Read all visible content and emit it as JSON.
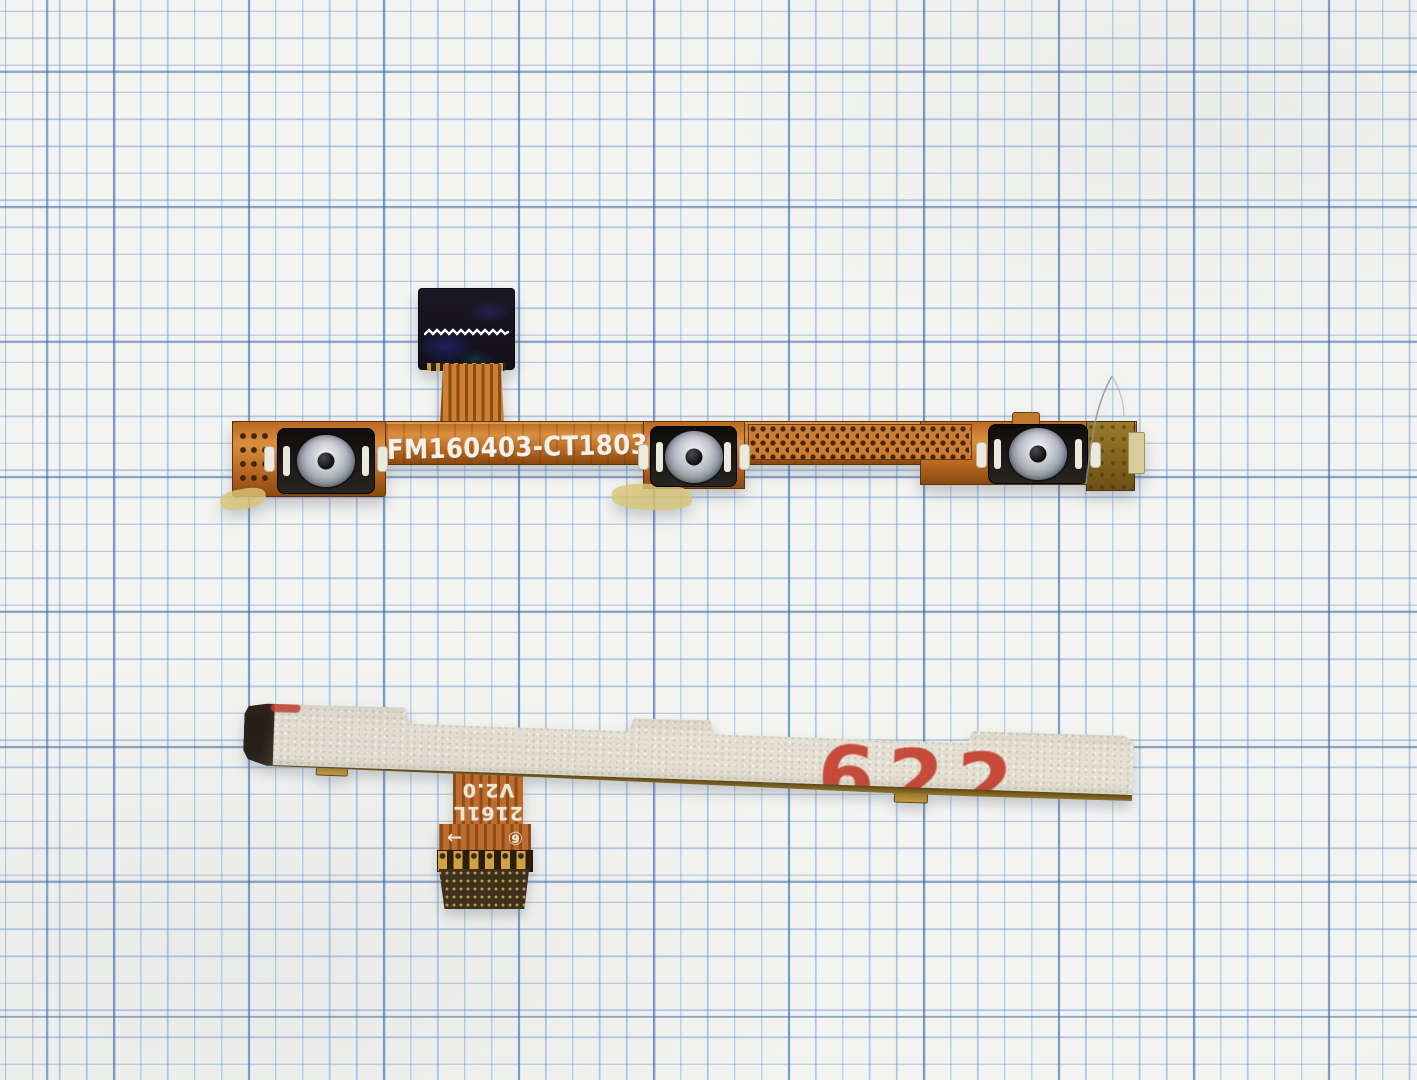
{
  "scene": {
    "subject": "Photograph of a smartphone power/volume button flex cable shown front side (top) and back adhesive side (bottom) on blue graph paper",
    "paper": {
      "background": "#f3f4f1",
      "minor_line_color": "#6292cd",
      "major_line_color": "#3464aa",
      "minor_step_px": 27,
      "major_step_px": 135
    }
  },
  "front_cable": {
    "part_number": "FM160403-CT1803M",
    "part_number_color": "#f4f1ea",
    "flex_copper_color": "#c1702b",
    "connector_color": "#17131d",
    "dome_silver_color": "#c6cad0",
    "button_count": 3,
    "features": [
      "board connector with white zigzag contact line",
      "three metal dome switches",
      "perforated copper mesh section",
      "gold end cap"
    ]
  },
  "back_cable": {
    "adhesive_color": "#e4dfd3",
    "gold_edge_color": "#8a671c",
    "red_marking": "622",
    "red_marking_color": "#c23b2b",
    "tail": {
      "line1": "2161L",
      "line2": "V2.0",
      "arrow_icon": "→",
      "circled_digit_icon": "⑥",
      "finger_count": 6
    }
  }
}
